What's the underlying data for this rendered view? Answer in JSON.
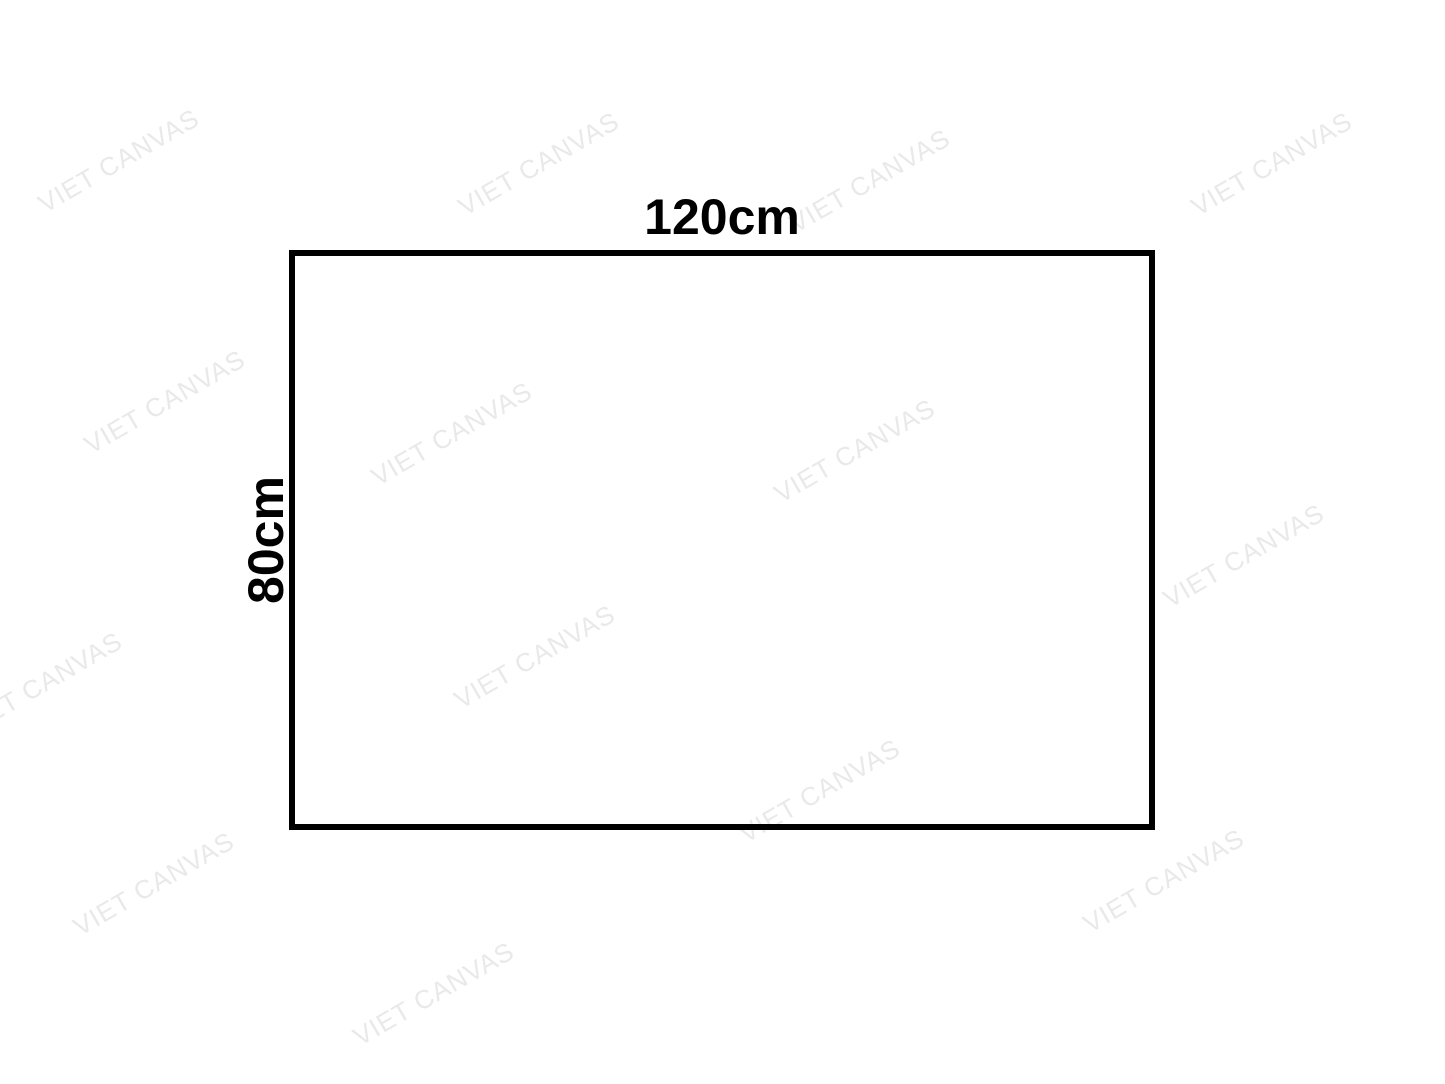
{
  "diagram": {
    "shape": "rectangle",
    "width_label": "120cm",
    "height_label": "80cm"
  },
  "watermark": {
    "text": "VIET CANVAS",
    "color": "#e9e9e9",
    "angle_deg": -30,
    "positions": [
      {
        "x": 47,
        "y": 217
      },
      {
        "x": 467,
        "y": 220
      },
      {
        "x": 798,
        "y": 237
      },
      {
        "x": 1200,
        "y": 220
      },
      {
        "x": 93,
        "y": 458
      },
      {
        "x": 380,
        "y": 490
      },
      {
        "x": 783,
        "y": 507
      },
      {
        "x": 1172,
        "y": 612
      },
      {
        "x": -30,
        "y": 740
      },
      {
        "x": 463,
        "y": 713
      },
      {
        "x": 82,
        "y": 940
      },
      {
        "x": 748,
        "y": 847
      },
      {
        "x": 362,
        "y": 1050
      },
      {
        "x": 1092,
        "y": 937
      }
    ]
  },
  "colors": {
    "background": "#ffffff",
    "border": "#000000",
    "label_text": "#000000"
  }
}
